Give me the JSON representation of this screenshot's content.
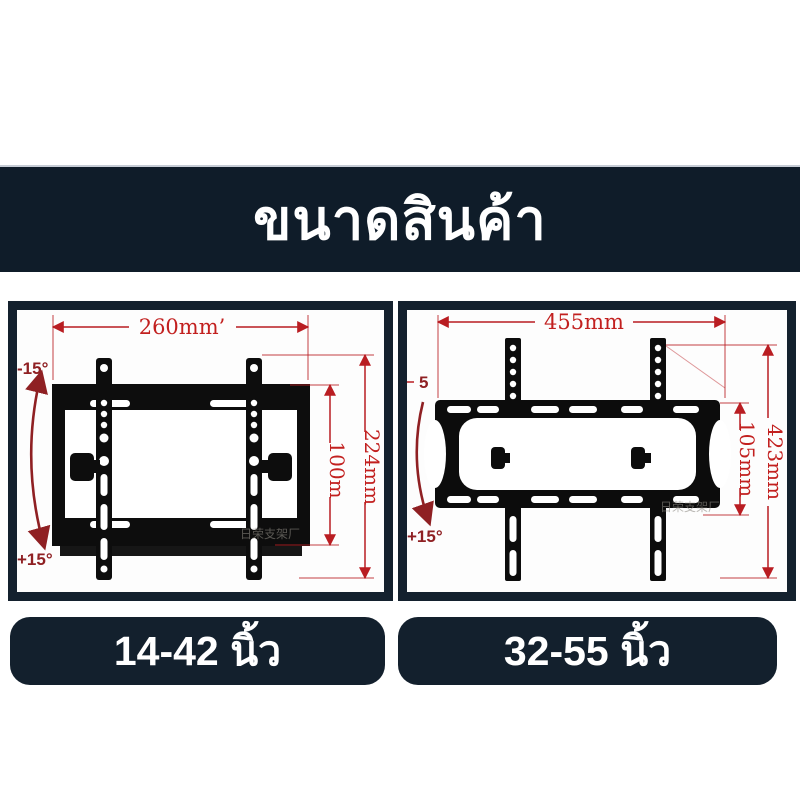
{
  "banner": {
    "title": "ขนาดสินค้า"
  },
  "diagrams": {
    "small": {
      "width": "260mm’",
      "inner_height": "100m",
      "outer_height": "224mm",
      "tilt_min": "-15°",
      "tilt_max": "+15°",
      "watermark": "日荣支架厂",
      "badge": "14-42 นิ้ว"
    },
    "large": {
      "width": "455mm",
      "inner_height": "105mm",
      "outer_height": "423mm",
      "tilt_min": "5",
      "tilt_max": "+15°",
      "watermark": "日荣支架厂",
      "badge": "32-55 นิ้ว"
    }
  },
  "colors": {
    "banner_navy": "#0f1c29",
    "panel_border_navy": "#14212e",
    "badge_navy": "#13202d",
    "dimension_red": "#b91d22",
    "tilt_label_red": "#8f2023",
    "bracket_black": "#0d0d0d"
  }
}
